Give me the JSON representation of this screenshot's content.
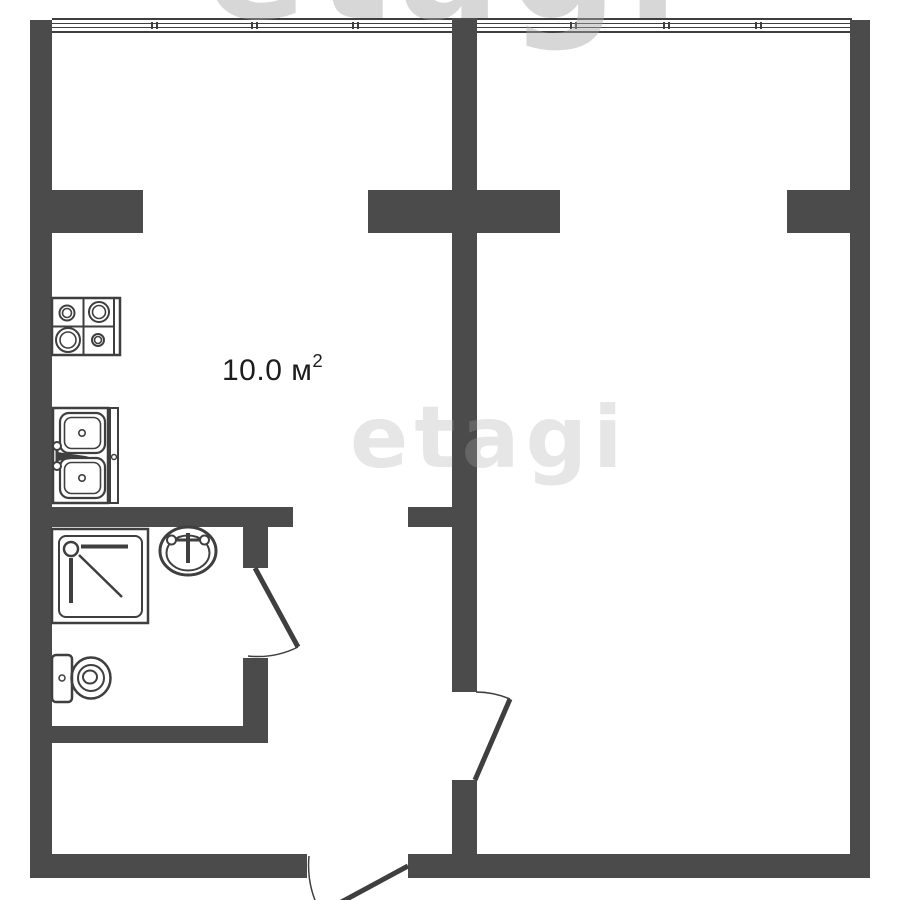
{
  "plan": {
    "type": "apartment-floor-plan",
    "labels": {
      "kitchen_area": {
        "value": "10.0 м",
        "superscript": "2"
      }
    },
    "watermark": {
      "text": "etagi"
    },
    "colors": {
      "wall": "#4b4b4b",
      "fixture_stroke": "#3f3f3f",
      "watermark": "#a8a8a8",
      "label_text": "#1d1d1d",
      "background": "#ffffff"
    },
    "fixtures": [
      "stove",
      "kitchen-sink",
      "shower-tray",
      "washbasin",
      "toilet"
    ],
    "doors": [
      "bathroom-door",
      "room-door",
      "entrance-door"
    ],
    "window_sections": 8
  }
}
